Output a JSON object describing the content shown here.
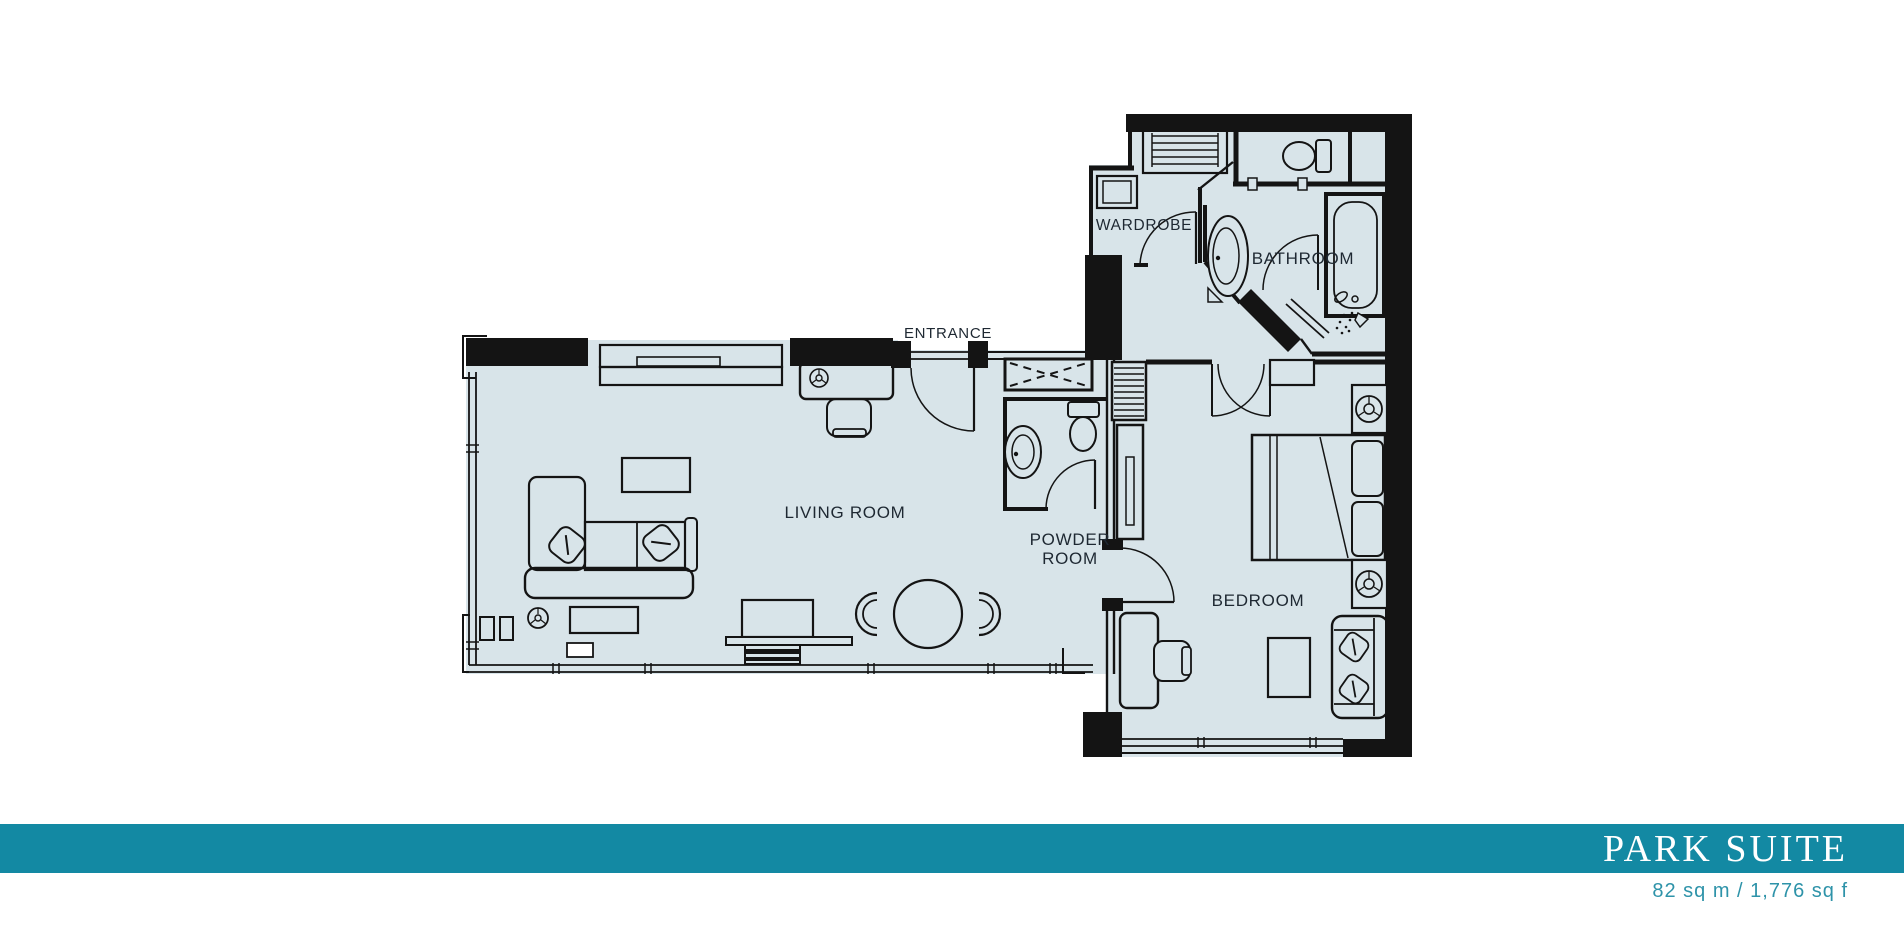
{
  "plan": {
    "labels": {
      "entrance": "ENTRANCE",
      "wardrobe": "WARDROBE",
      "bathroom": "BATHROOM",
      "living_room": "LIVING ROOM",
      "powder_room": "POWDER ROOM",
      "bedroom": "BEDROOM"
    }
  },
  "footer": {
    "title": "PARK SUITE",
    "area": "82 sq m / 1,776 sq f"
  },
  "colors": {
    "banner": "#1389a3",
    "area_text": "#2e93a9",
    "floor": "#d8e4e9",
    "line": "#141414"
  }
}
